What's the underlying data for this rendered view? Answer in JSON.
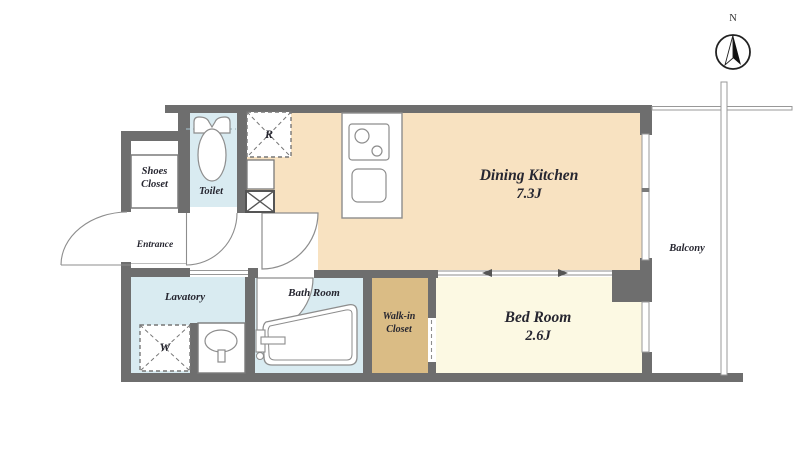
{
  "plan": {
    "rooms": {
      "dining_kitchen": {
        "name": "Dining Kitchen",
        "size": "7.3J"
      },
      "bed_room": {
        "name": "Bed Room",
        "size": "2.6J"
      },
      "toilet": {
        "label": "Toilet"
      },
      "shoes_closet": {
        "line1": "Shoes",
        "line2": "Closet"
      },
      "entrance": {
        "label": "Entrance"
      },
      "lavatory": {
        "label": "Lavatory"
      },
      "bath_room": {
        "label": "Bath Room"
      },
      "walk_in_closet": {
        "line1": "Walk-in",
        "line2": "Closet"
      },
      "balcony": {
        "label": "Balcony"
      }
    },
    "markers": {
      "refrigerator": "R",
      "washer": "W",
      "north": "N"
    },
    "colors": {
      "wall": "#6e6e6e",
      "dining_kitchen_floor": "#f8e2c1",
      "bed_room_floor": "#fcf9e3",
      "wet_area_floor": "#d9ebf1",
      "closet_floor": "#dabc85",
      "fixture_outline": "#8d8d8d",
      "text": "#262630"
    }
  }
}
